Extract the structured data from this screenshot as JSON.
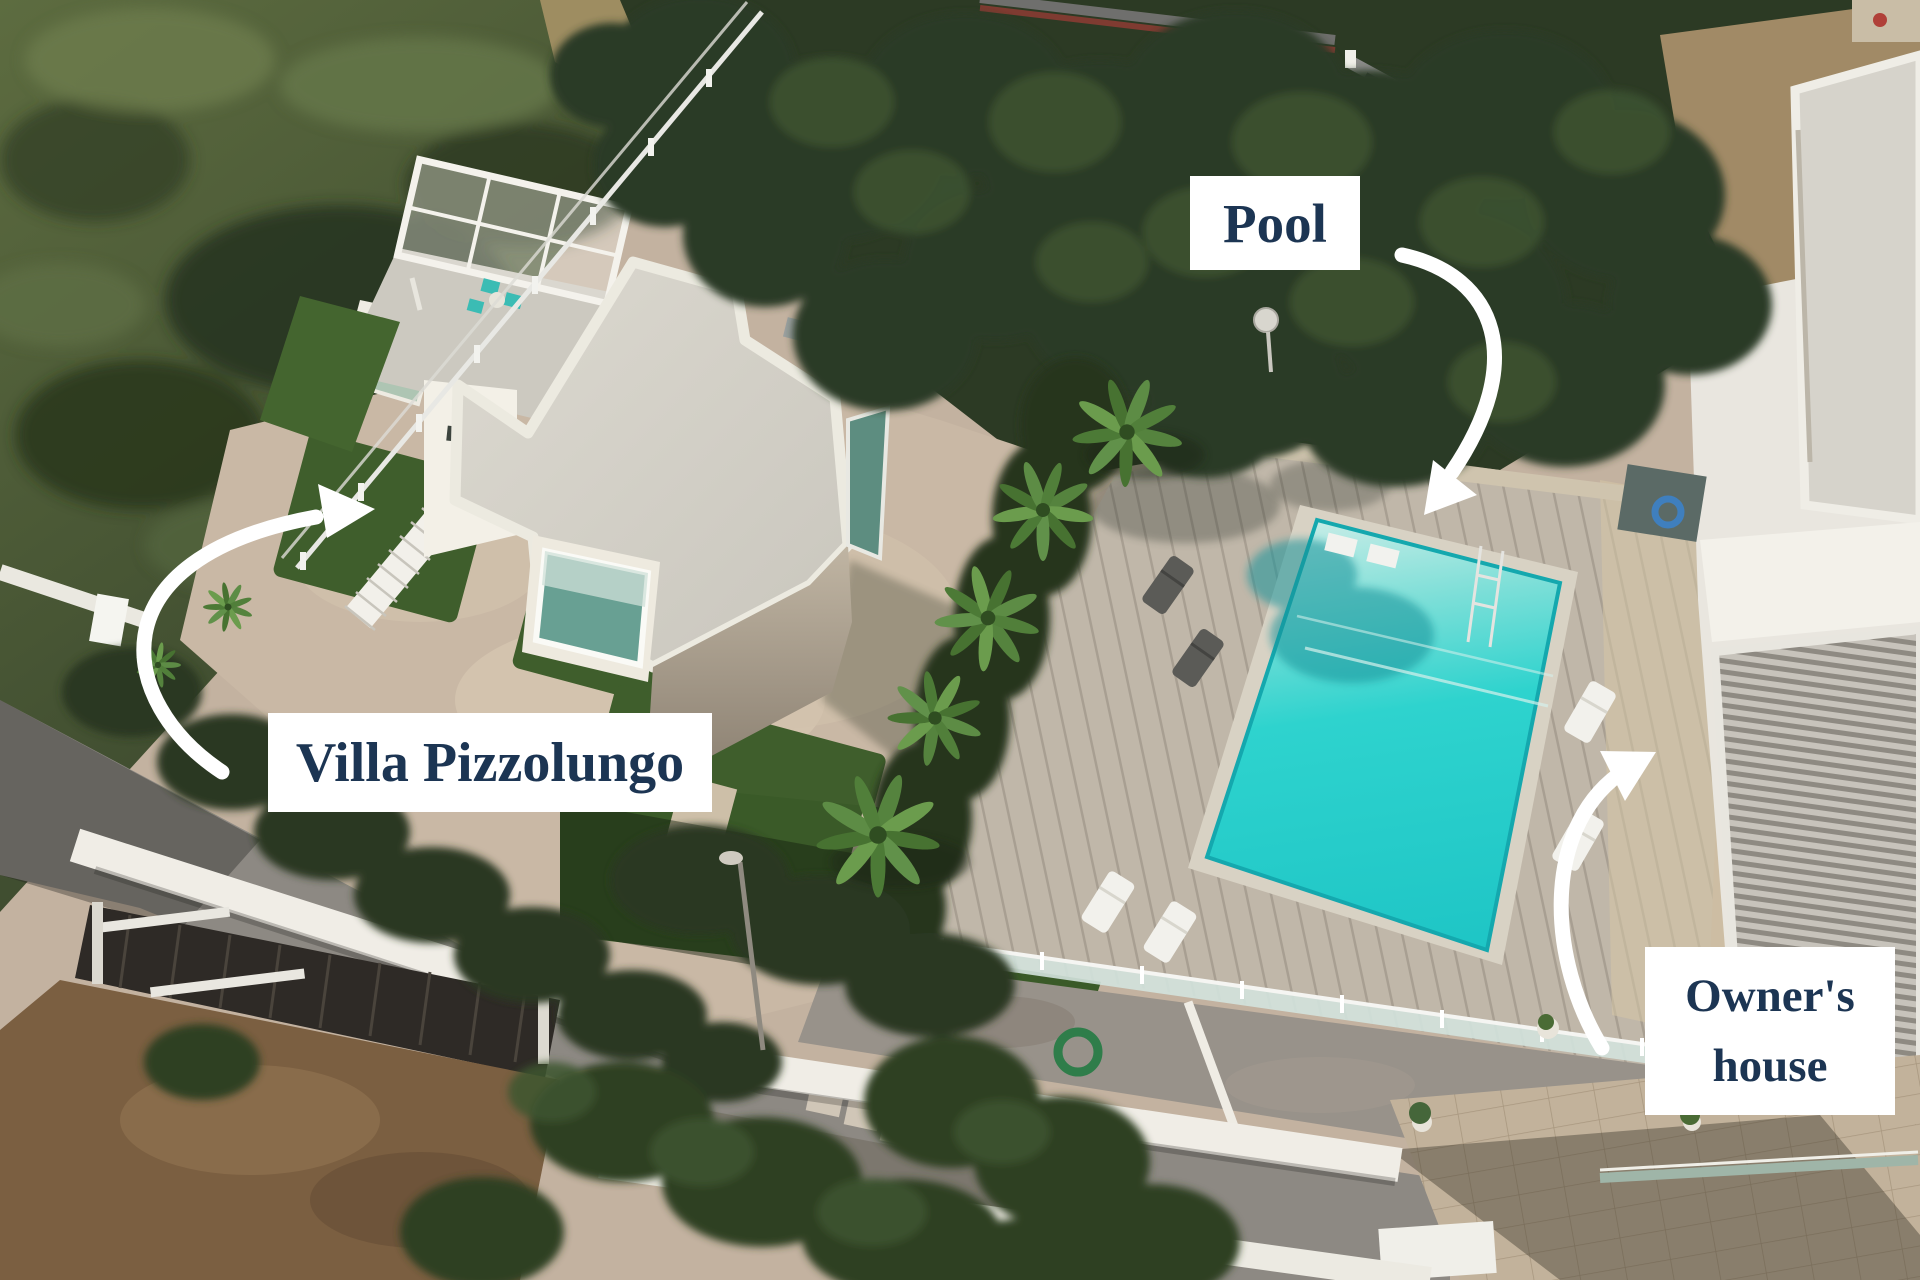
{
  "annotations": {
    "villa": {
      "label": "Villa Pizzolungo"
    },
    "pool": {
      "label": "Pool"
    },
    "owners_house": {
      "label": "Owner's house"
    }
  },
  "colors": {
    "label_background": "#ffffff",
    "label_text": "#1c3553",
    "arrow": "#ffffff",
    "pool_water": "#2ed3ce"
  }
}
